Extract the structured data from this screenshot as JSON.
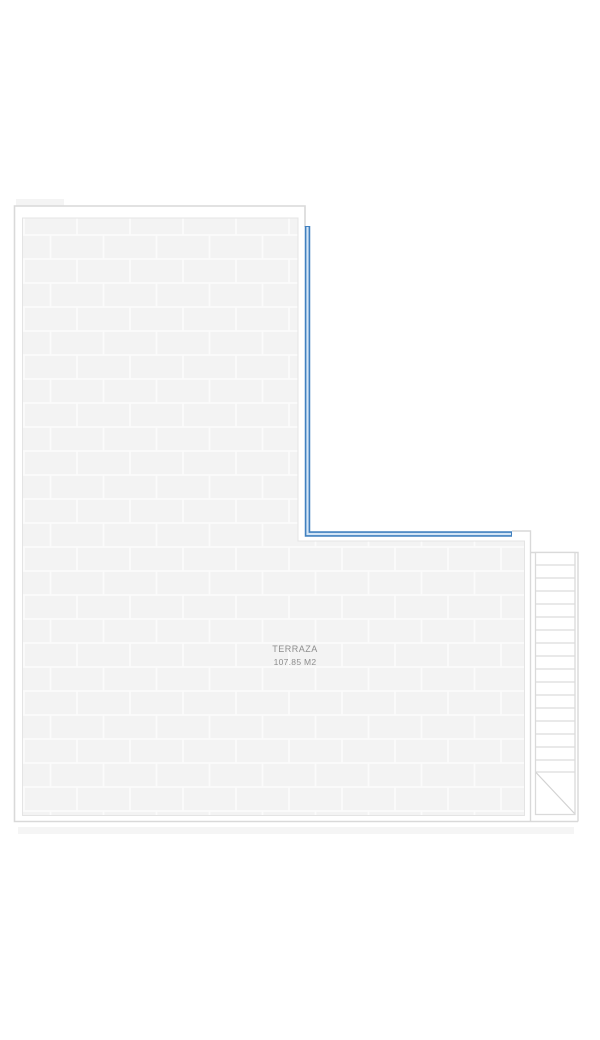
{
  "plan": {
    "room_label": "TERRAZA",
    "room_area": "107.85 M2",
    "colors": {
      "accent_blue_dark": "#4180bf",
      "accent_blue_light": "#d3e5f6",
      "wall_line": "#d9d9d9",
      "stair_line": "#dcdcdc",
      "tile_fill": "#f3f3f3",
      "tile_grout": "#fbfbfb",
      "tile_edge": "#e4e4e4",
      "label_text": "#8d8d8d",
      "canvas": "#ffffff"
    }
  }
}
